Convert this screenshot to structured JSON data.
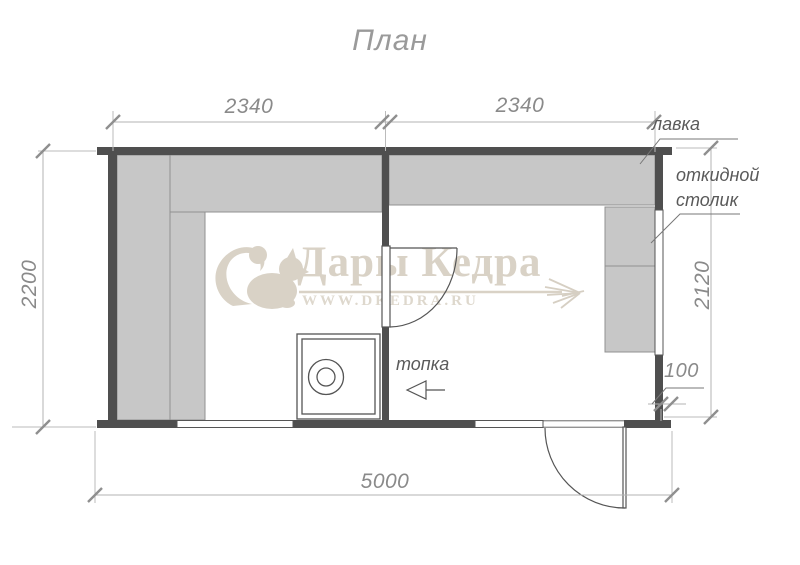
{
  "title": "План",
  "watermark": {
    "brand": "Дары Кедра",
    "website": "WWW.DKEDRA.RU",
    "color": "#d9d2c6"
  },
  "dimensions": {
    "top_left_room_width": "2340",
    "top_right_room_width": "2340",
    "left_height": "2200",
    "right_height": "2120",
    "overall_width": "5000",
    "table_offset": "100"
  },
  "labels": {
    "bench": "лавка",
    "folding_table_line1": "откидной",
    "folding_table_line2": "столик",
    "stove": "топка"
  },
  "colors": {
    "wall": "#4f4f4f",
    "bench_fill": "#c7c7c7",
    "bench_border": "#909090",
    "drawing_line": "#555555",
    "dimension_line": "#b3b3b3",
    "dimension_text": "#8a8a8a",
    "watermark": "#d9d2c6"
  }
}
